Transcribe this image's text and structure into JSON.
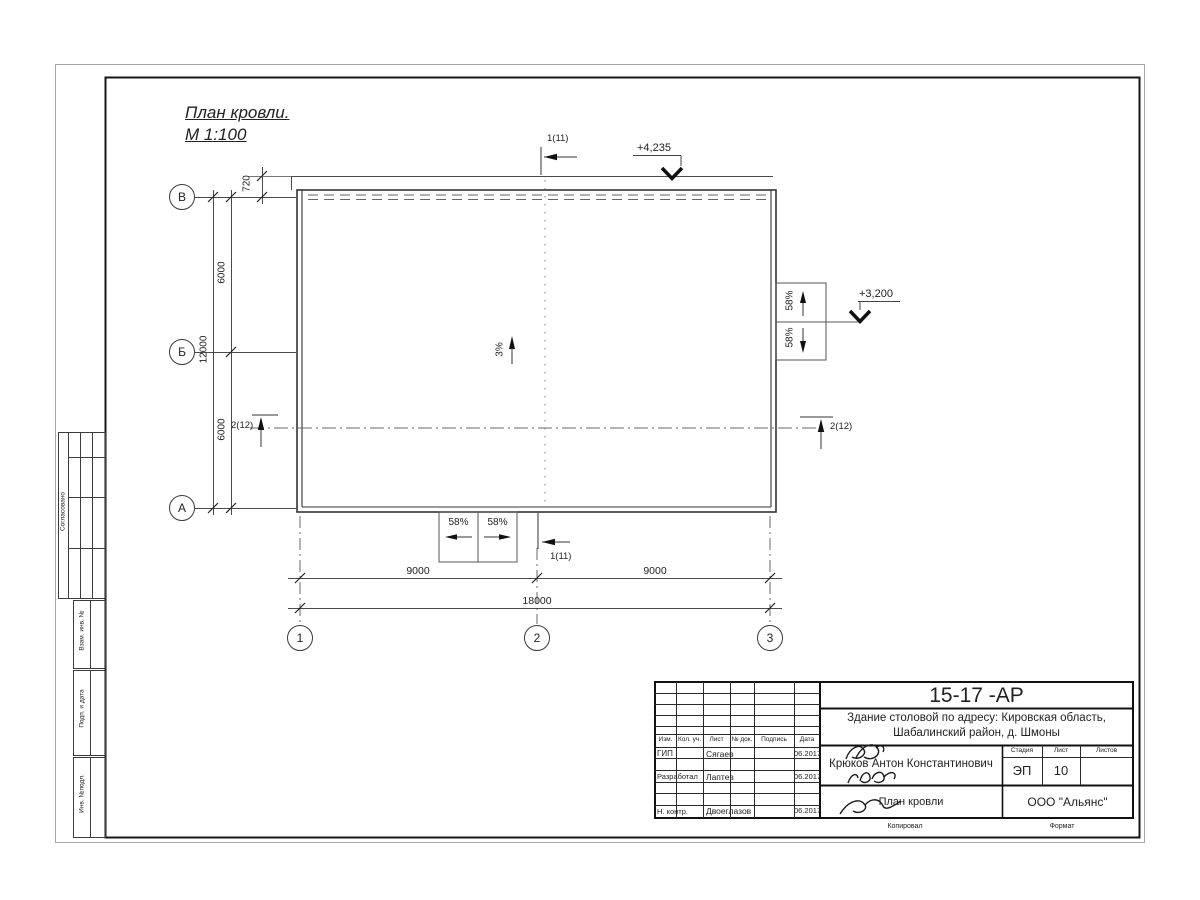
{
  "title": {
    "name": "План кровли.",
    "scale": "М 1:100"
  },
  "elevations": {
    "top": "+4,235",
    "right": "+3,200"
  },
  "slopes": {
    "main": "3%",
    "side": "58%"
  },
  "sections": {
    "s1": "1(11)",
    "s2": "2(12)"
  },
  "dims": {
    "d720": "720",
    "d6000": "6000",
    "d12000": "12000",
    "d9000": "9000",
    "d18000": "18000"
  },
  "axes": {
    "row_v": "В",
    "row_b": "Б",
    "row_a": "А",
    "col1": "1",
    "col2": "2",
    "col3": "3"
  },
  "frame_labels": {
    "soglasovano": "Согласовано",
    "vzam_inv": "Взам. инв. №",
    "podp_data": "Подп. и дата",
    "inv_podl": "Инв. №подл.",
    "kopiroval": "Копировал",
    "format": "Формат"
  },
  "titleblock": {
    "doc_number": "15-17 -АР",
    "object_line1": "Здание столовой по адресу: Кировская область,",
    "object_line2": "Шабалинский район, д. Шмоны",
    "headers": {
      "izm": "Изм.",
      "kol_uch": "Кол. уч.",
      "list": "Лист",
      "no_dok": "№ док.",
      "podpis": "Подпись",
      "data": "Дата",
      "stadia": "Стадия",
      "list2": "Лист",
      "listov": "Листов"
    },
    "rows": [
      {
        "role": "ГИП",
        "name": "Сягаев",
        "date": "06.2017"
      },
      {
        "role": "Разработал",
        "name": "Лаптев",
        "date": "06.2017"
      },
      {
        "role": "Н. контр.",
        "name": "Двоеглазов",
        "date": "06.2017"
      }
    ],
    "author": "Крюков Антон Константинович",
    "stage": "ЭП",
    "sheet": "10",
    "sheets_total": "",
    "drawing_title": "План кровли",
    "company": "ООО \"Альянс\""
  }
}
